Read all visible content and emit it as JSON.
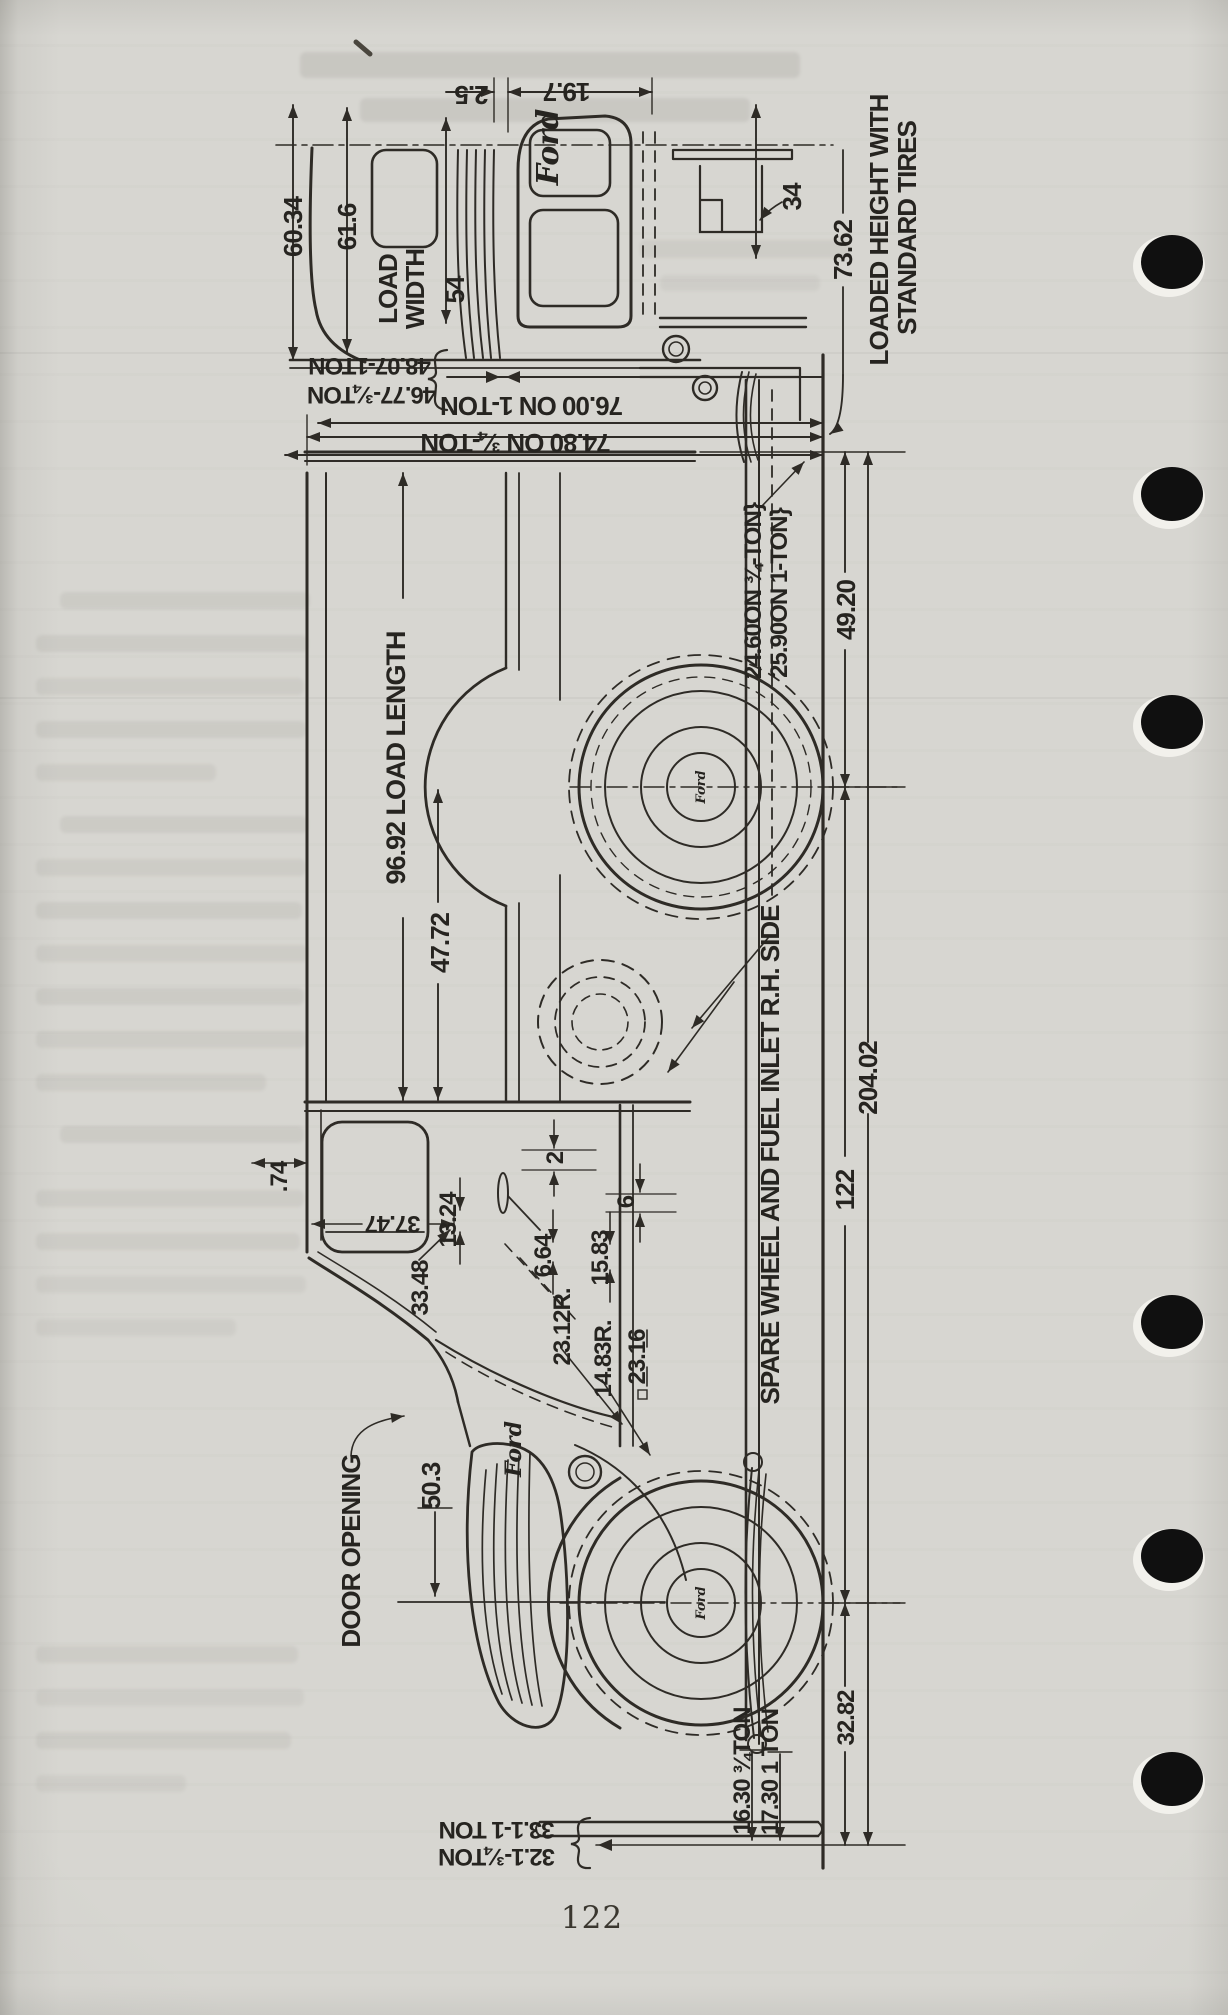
{
  "page_number": "122",
  "ford_logo": "Ford",
  "colors": {
    "paper": "#d7d6d1",
    "ink": "#2e2b26"
  },
  "labels": {
    "width_outer": "60.34",
    "width_upper": "61.6",
    "load_width_1": "LOAD",
    "load_width_2": "WIDTH",
    "load_width_value": "54",
    "dim_2_5": "2.5",
    "dim_19_7": "19.7",
    "dim_34": "34",
    "loaded_height_value": "73.62",
    "loaded_height_text_1": "LOADED HEIGHT WITH",
    "loaded_height_text_2": "STANDARD TIRES",
    "height_1ton": "48.07-1TON",
    "height_34ton": "46.77-¾TON",
    "overall_height_1ton": "76.00 ON 1-TON",
    "overall_height_34ton": "74.80 ON ¾-TON",
    "rear_overhang": "49.20",
    "floor_height_34ton": "24.60ON ¾-TON}",
    "floor_height_1ton": "25.90ON 1-TON}",
    "load_length": "96.92 LOAD LENGTH",
    "dim_47_72": "47.72",
    "overall_length": "204.02",
    "wheelbase": "122",
    "spare_note": "SPARE WHEEL AND FUEL INLET R.H. SIDE",
    "dim_0_74": ".74",
    "dim_37_47": "37.47",
    "dim_13_24": "13.24",
    "dim_33_48": "33.48",
    "dim_6_64": "6.64",
    "dim_15_83": "15.83",
    "dim_2": "2",
    "dim_6": "6",
    "radius_23_12": "23.12R.",
    "radius_14_83": "14.83R.",
    "dim_23_16": "23.16",
    "door_opening": "DOOR OPENING",
    "dim_50_3": "50.3",
    "front_34ton": "16.30 ¾TON",
    "front_1ton": "17.30 1 TON",
    "dim_32_82": "32.82",
    "bumper_34ton": "32.1-¾TON",
    "bumper_1ton": "33.1-1 TON"
  }
}
